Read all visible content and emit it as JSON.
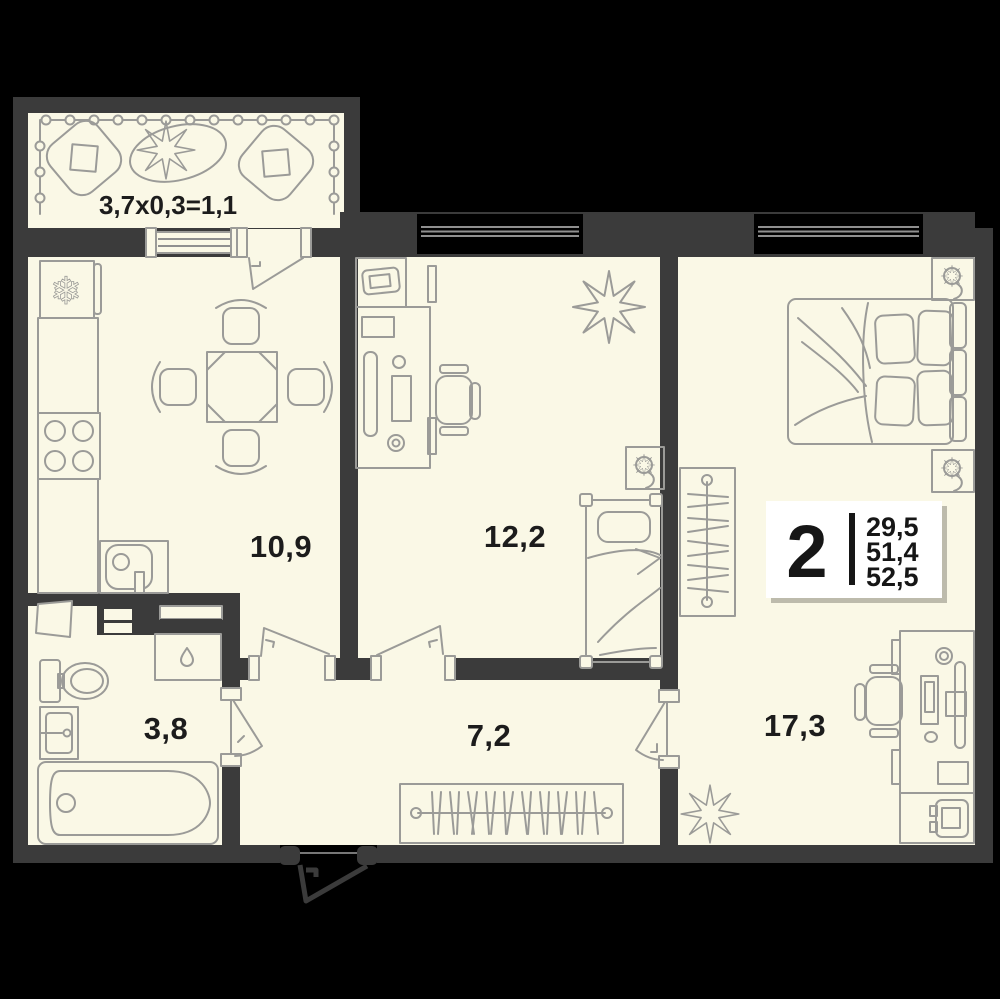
{
  "floor_plan": {
    "balcony": {
      "dimension_label": "3,7x0,3=1,1"
    },
    "rooms": {
      "kitchen": {
        "area": "10,9"
      },
      "living_room": {
        "area": "12,2"
      },
      "bedroom": {
        "area": "17,3"
      },
      "bathroom": {
        "area": "3,8"
      },
      "hallway": {
        "area": "7,2"
      }
    },
    "info_badge": {
      "room_count": "2",
      "living_area": "29,5",
      "area_without_balcony": "51,4",
      "total_area": "52,5"
    },
    "icons": {
      "fridge_glyph": "❄"
    },
    "colors": {
      "background": "#000000",
      "walls": "#3b3b3b",
      "floor": "#faf8e6",
      "furniture_outline": "#9b9b98",
      "label_text": "#1c1c1c",
      "badge_background": "#ffffff"
    }
  }
}
